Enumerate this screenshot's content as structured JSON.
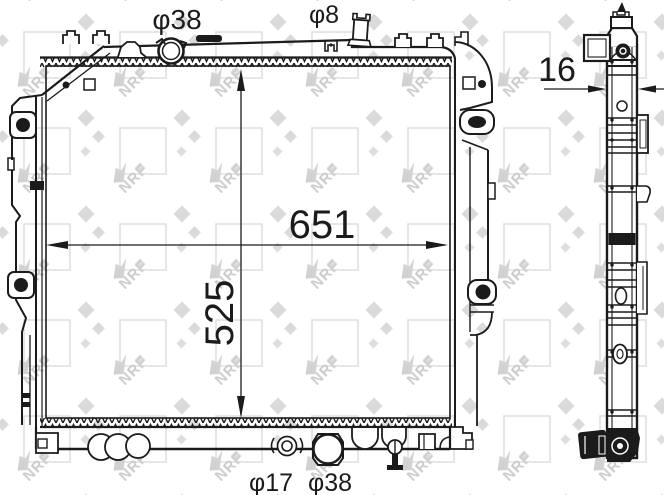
{
  "drawing": {
    "watermark_text": "NRF",
    "dimensions": {
      "width": "651",
      "height": "525",
      "depth": "16"
    },
    "ports": {
      "top_filler": "φ38",
      "top_overflow": "φ8",
      "bottom_drain": "φ17",
      "bottom_outlet": "φ38"
    },
    "colors": {
      "line": "#1b1b1b",
      "watermark": "#d8d8d8",
      "background": "#ffffff"
    }
  }
}
